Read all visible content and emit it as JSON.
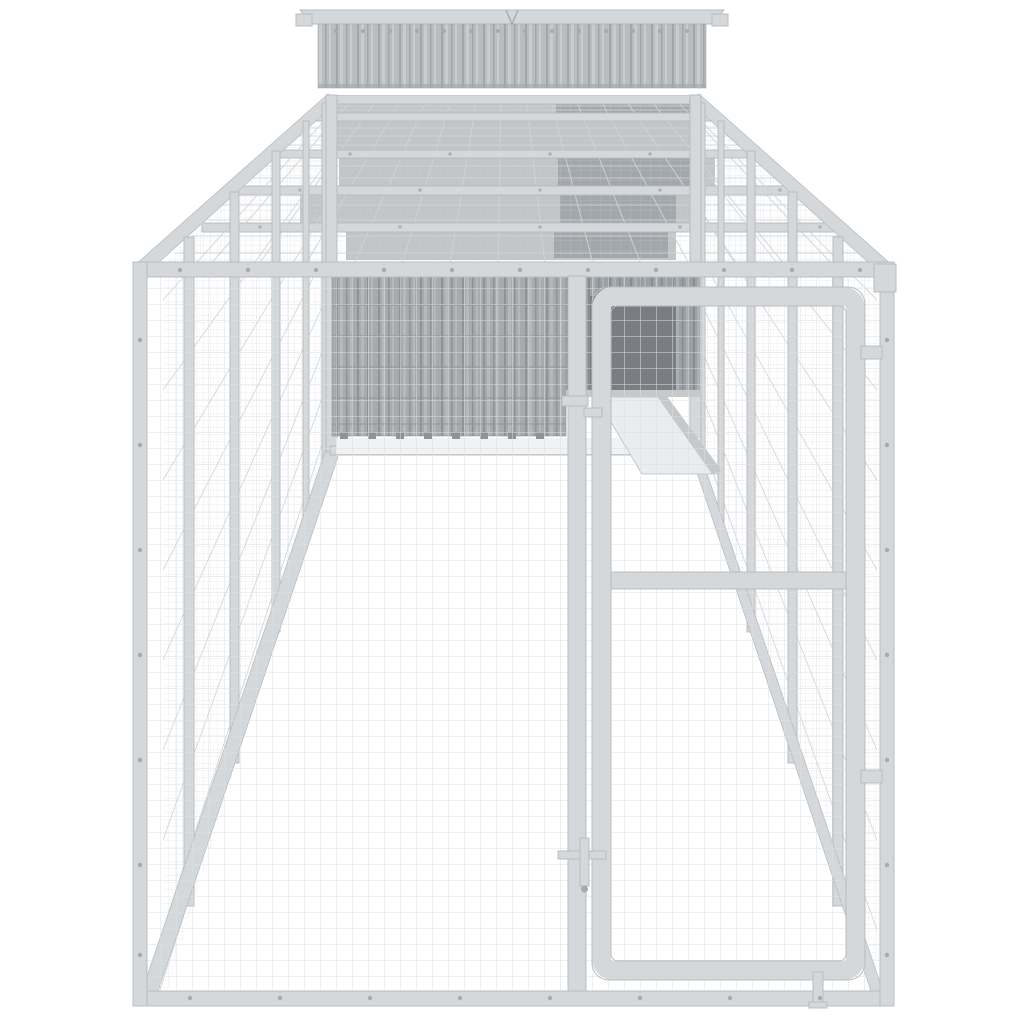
{
  "image": {
    "type": "product-photo",
    "subject": "Galvanised steel dog kennel run with roof-mounted coop house, wire mesh walls and front mesh door",
    "background": "#ffffff"
  },
  "parts": {
    "scene": "kennel-product-photo",
    "house": "coop-house-corrugated-top",
    "houseRoof": "coop-roof-cap",
    "roof": "run-mesh-roof",
    "leftWall": "left-mesh-wall",
    "rightWall": "right-mesh-wall",
    "interior": "run-interior-with-coop-base",
    "coopDoorway": "coop-entry-opening",
    "ramp": "coop-entry-ramp",
    "frontFrame": "front-steel-frame",
    "frontMesh": "front-mesh-panel",
    "door": "front-mesh-door",
    "latch": "door-latch",
    "bolt": "door-drop-bolt",
    "rivets": "frame-rivets"
  },
  "palette": {
    "bg": "#ffffff",
    "frame": "#d5d8da",
    "frameEdge": "#b9bdc0",
    "mesh": "#dcdfe1",
    "meshDense": "#cfd3d6",
    "corrugBase": "#b9bdc0",
    "corrugRibDark": "#a2a6a9",
    "corrugRibLight": "#c8cccf",
    "corrugBase2": "#a7abae",
    "corrugRibDark2": "#8f9396",
    "corrugRibLight2": "#b5b9bc",
    "corrugBase3": "#9aa0a4",
    "corrugRibDark3": "#868c90",
    "corrugRibLight3": "#a9afb3",
    "shadowBand": "#8f959a",
    "shadowDeep": "#7d8388",
    "doorway": "#7a7e82",
    "rampFace": "#eaecee",
    "rampEdge": "#c5c9cc",
    "rivet": "#a6aaad",
    "floorShadow": "#f0f2f3",
    "seam": "#94989b"
  }
}
